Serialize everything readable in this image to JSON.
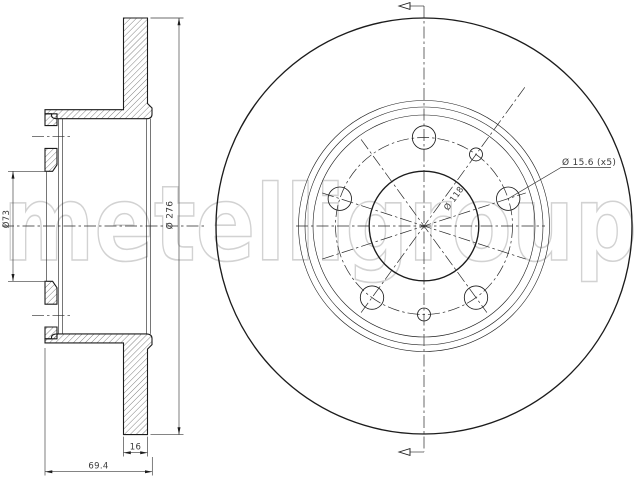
{
  "drawing": {
    "type": "brake-disc-technical-drawing",
    "watermark": {
      "text": "metelligroup",
      "color": "#d2d2d2"
    },
    "dimensions": {
      "hub_bore": "Ø73",
      "outer_diameter": "Ø 276",
      "disc_thickness": "16",
      "overall_height": "69.4",
      "bolt_hole_diameter": "Ø 15.6 (x5)",
      "bolt_circle_diameter": "Ø 118"
    },
    "colors": {
      "line": "#1c1c1c",
      "dimension_text": "#3a3a3a",
      "watermark": "#d2d2d2",
      "background": "#ffffff"
    }
  }
}
